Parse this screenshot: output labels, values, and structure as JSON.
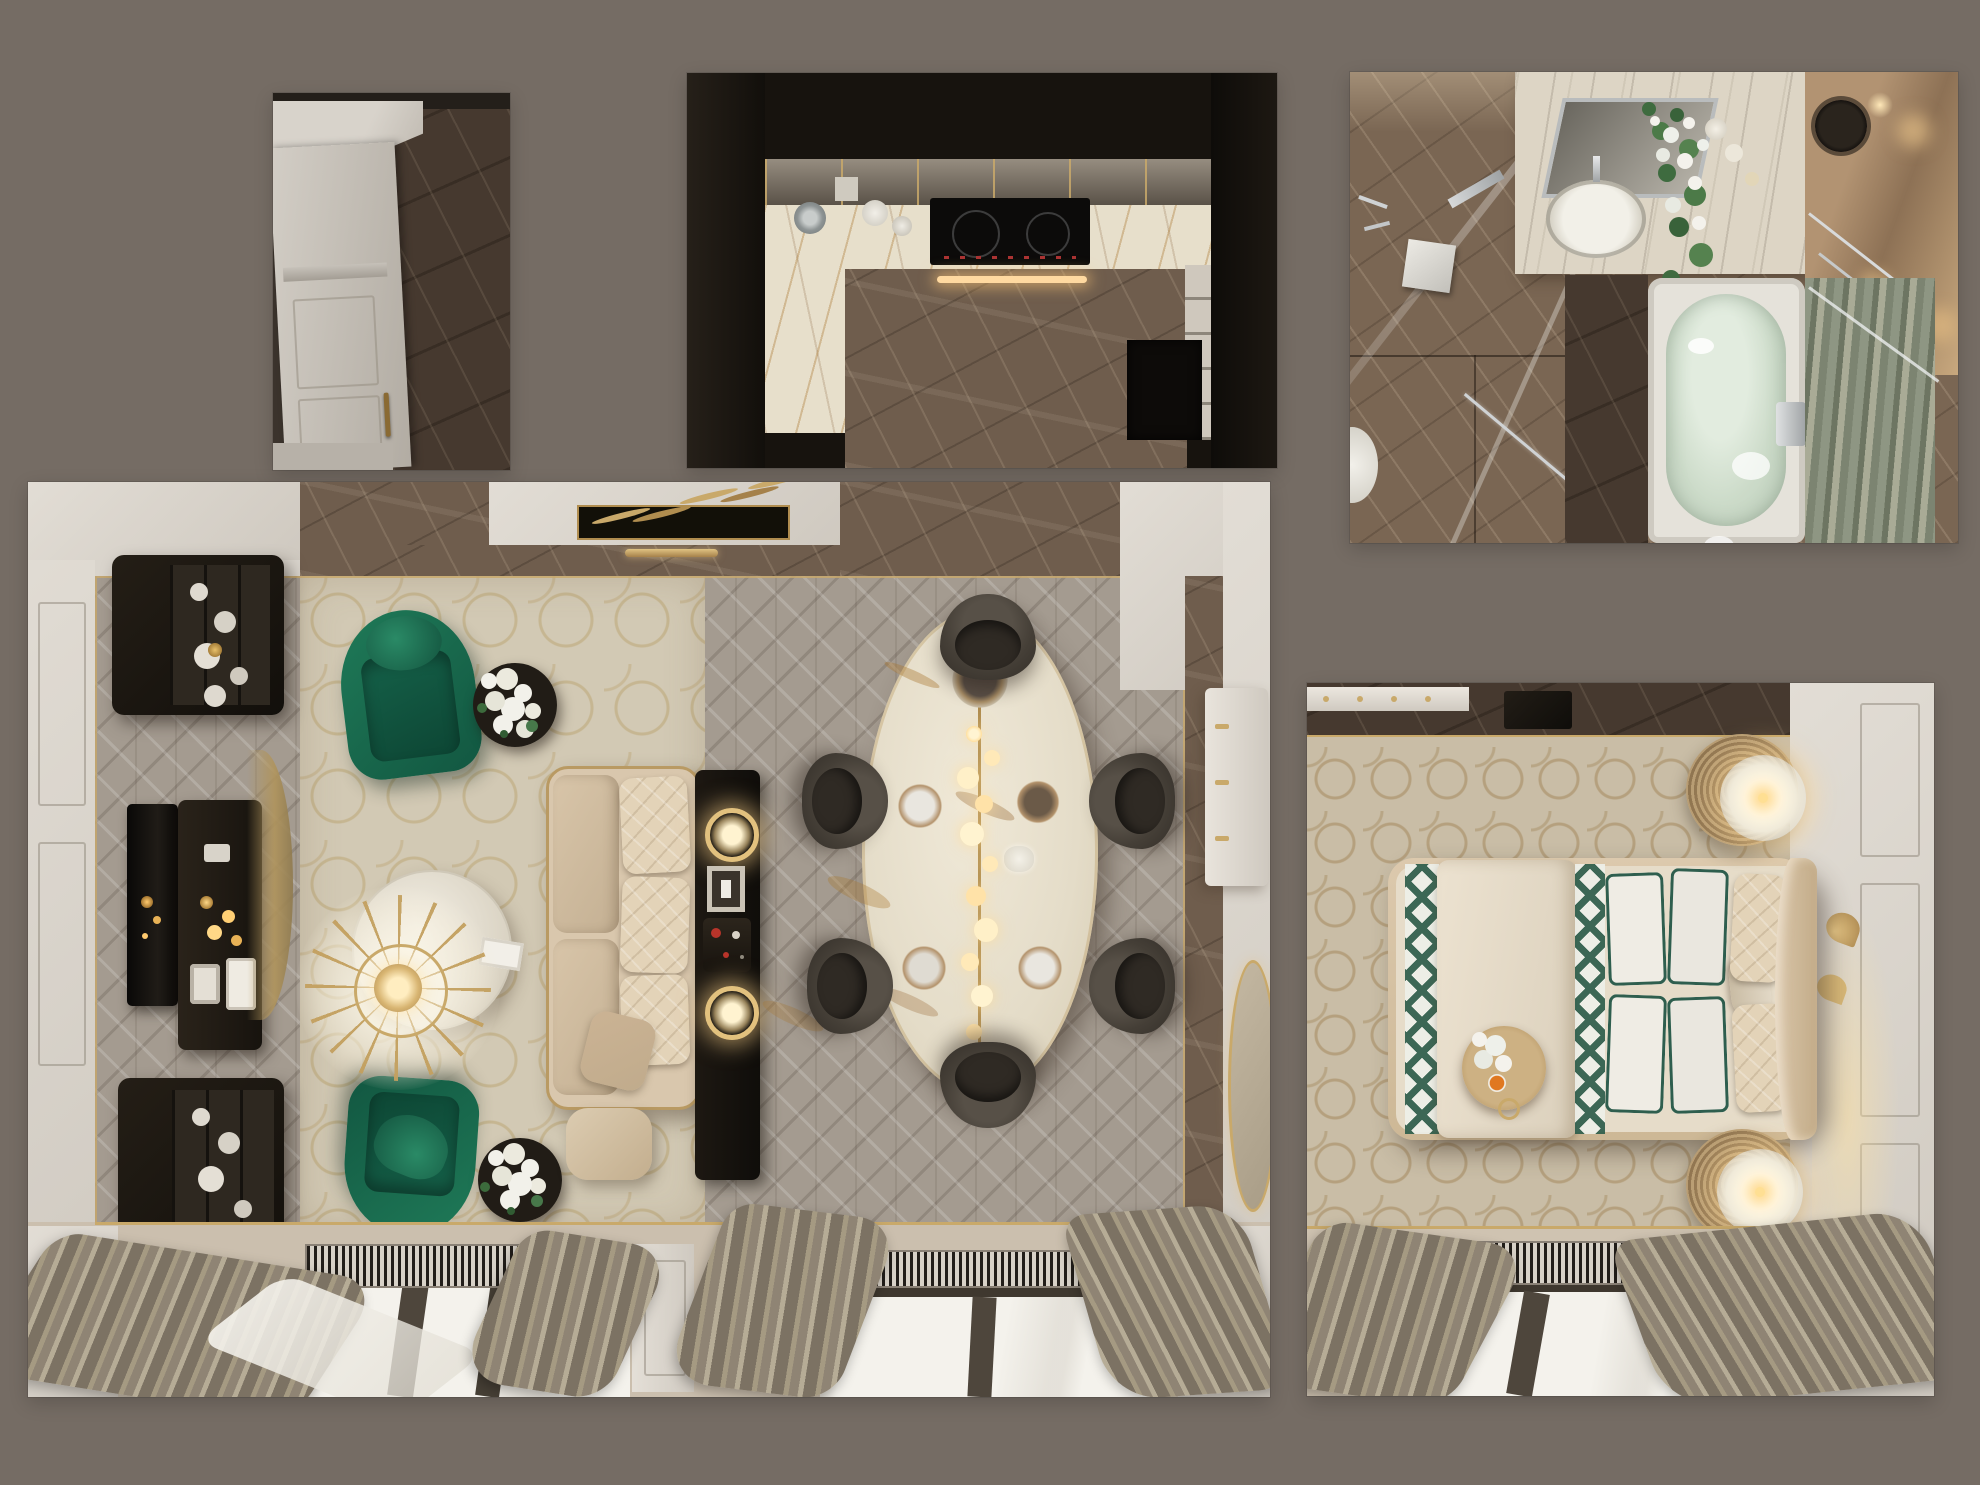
{
  "meta": {
    "title": "Apartment interior design – top-down 3D render collage",
    "background_color": "#756C64",
    "render_type": "photorealistic floor-plan renders, no visible text"
  },
  "palette": {
    "background": "#756C64",
    "wall_white": "#DCD7CF",
    "marble_brown": "#6F5D4D",
    "marble_dark": "#46392F",
    "marble_white_gold": "#E7DFCB",
    "herringbone_wood": "#A49B90",
    "carpet_beige": "#D2C9B4",
    "accent_gold": "#C9A96A",
    "accent_emerald": "#1B6B4F",
    "sofa_beige": "#D9C7AD",
    "curtain_taupe": "#8F8474",
    "water_green": "#CCDBC9"
  },
  "panels": {
    "hallway": {
      "title": "Entrance hallway – white paneled door and dark marble floor (top view)",
      "objects": [
        "white-entry-door",
        "brass-door-handle",
        "dark-marble-floor"
      ]
    },
    "kitchen": {
      "title": "Kitchen – dark cabinetry, gold-veined marble counters, induction cooktop (top view)",
      "objects": [
        "mirrored-upper-cabinets",
        "marble-countertop",
        "induction-cooktop",
        "led-strip",
        "teapot",
        "cookware",
        "brown-marble-floor",
        "doorway"
      ]
    },
    "bathroom": {
      "title": "Bathroom – walk-in shower, marble vanity with sink, oval bathtub (top view)",
      "objects": [
        "shower-head",
        "glass-partition",
        "vanity-mirror",
        "oval-sink",
        "flower-arrangement",
        "candles",
        "wall-sconce-glow",
        "bathtub-with-water",
        "onyx-glass-panel",
        "toilet"
      ]
    },
    "living_dining": {
      "title": "Living and dining room – emerald armchairs, beige sofa, crystal chandelier, oval marble dining table (top view)",
      "objects": [
        "display-vitrine-top",
        "display-vitrine-bottom",
        "tv-screen",
        "media-console",
        "emerald-armchair-1",
        "emerald-armchair-2",
        "hydrangea-side-table-1",
        "hydrangea-side-table-2",
        "beige-sofa",
        "pouf",
        "sofa-back-console",
        "ring-lamp-1",
        "ring-lamp-2",
        "vintage-radio",
        "coffee-table",
        "crystal-chandelier",
        "oval-dining-table",
        "pendant-bubbles",
        "dining-chairs-x6",
        "ceiling-fern-artwork",
        "gold-pendant-bar",
        "white-chest",
        "gold-oval-mirror",
        "radiator-1",
        "radiator-2",
        "window-1",
        "window-2",
        "taupe-curtains",
        "herringbone-floor",
        "patterned-carpet"
      ]
    },
    "bedroom": {
      "title": "Bedroom – upholstered bed with green-trim pillows, rattan nightstands with glowing lamps, gold leaf wall art (top view)",
      "objects": [
        "bed",
        "duvet",
        "diamond-throw",
        "pillows-green-trim",
        "breakfast-tray",
        "nightstand-lamp-top",
        "nightstand-lamp-bottom",
        "gold-leaf-art",
        "dresser",
        "radiator",
        "window",
        "taupe-curtains",
        "moroccan-carpet"
      ]
    }
  }
}
